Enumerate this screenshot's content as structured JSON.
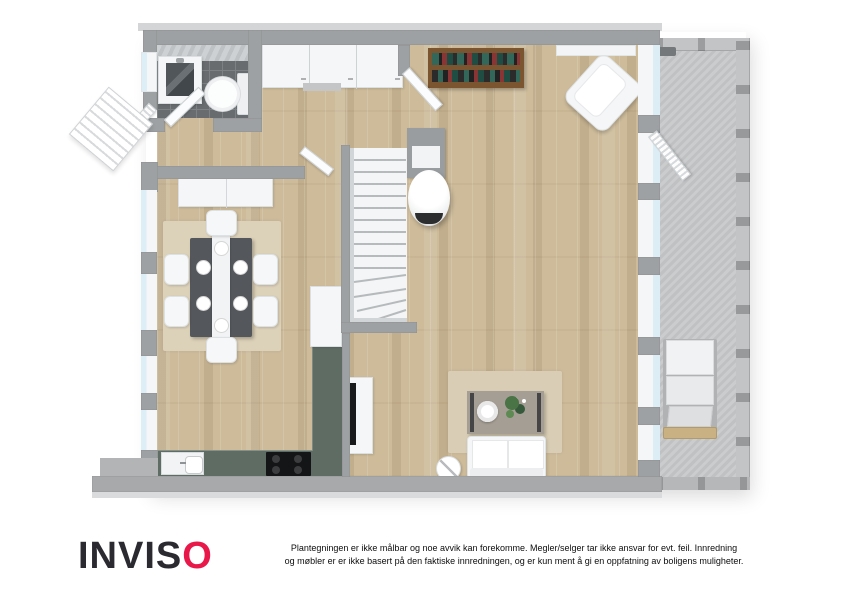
{
  "branding": {
    "logo": {
      "prefix": "INVIS",
      "accent_letter": "O",
      "text_color": "#2a2a30",
      "accent_color": "#e8194a"
    },
    "disclaimer": {
      "line1": "Plantegningen er ikke målbar og noe avvik kan forekomme. Megler/selger tar ikke ansvar for evt. feil. Innredning",
      "line2": "og møbler er er ikke basert på den faktiske innredningen, og er kun ment å gi en oppfatning av boligens muligheter."
    }
  },
  "floor_plan": {
    "type": "residential-floorplan-top-view",
    "rooms": [
      {
        "name": "bathroom",
        "floor": "dark-gray-tile"
      },
      {
        "name": "hallway",
        "floor": "oak-wood"
      },
      {
        "name": "dining-room",
        "floor": "oak-wood"
      },
      {
        "name": "kitchen",
        "floor": "oak-wood"
      },
      {
        "name": "living-room",
        "floor": "oak-wood"
      },
      {
        "name": "terrace",
        "floor": "concrete-gray"
      }
    ],
    "furniture": [
      "shower",
      "toilet",
      "entrance-steps",
      "wardrobe",
      "sideboard",
      "dining-table",
      "table-runner",
      "dining-chairs-x6",
      "area-rug-dining",
      "kitchen-counter-l-shape",
      "sink",
      "cooktop",
      "tall-cabinet",
      "staircase",
      "wood-stove",
      "chimney",
      "tv-bench",
      "tv",
      "bookshelf",
      "window-top",
      "armchair",
      "area-rug-living",
      "coffee-table",
      "decor-bowl",
      "decor-plant",
      "sofa",
      "side-table",
      "terrace-bench",
      "lounge-chair",
      "terrace-railing"
    ],
    "colors": {
      "wall": "#9ea1a3",
      "wood_floor": "#cdbb9a",
      "tile_floor": "#686c6f",
      "terrace_floor": "#c6c8ca",
      "kitchen_counter": "#5e6c64",
      "rug": "#dbd0b7",
      "window_glass": "#dcedf6",
      "bookshelf_wood": "#7b5530",
      "lounge_wood": "#c9b184"
    }
  }
}
